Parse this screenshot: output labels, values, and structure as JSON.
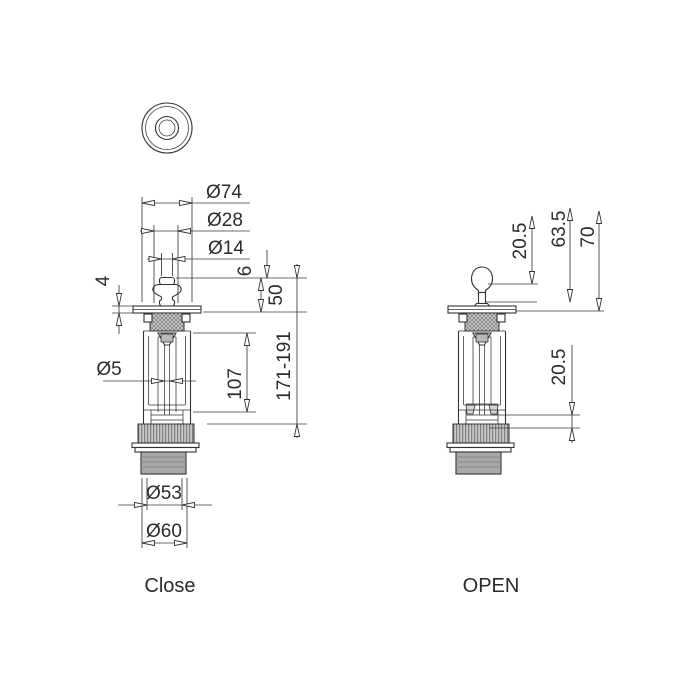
{
  "views": {
    "close": {
      "label": "Close"
    },
    "open": {
      "label": "OPEN"
    }
  },
  "dims": {
    "close": {
      "dia74": "Ø74",
      "dia28": "Ø28",
      "dia14": "Ø14",
      "six": "6",
      "fifty": "50",
      "range": "171-191",
      "one07": "107",
      "four": "4",
      "dia5": "Ø5",
      "dia53": "Ø53",
      "dia60": "Ø60"
    },
    "open": {
      "top_lift": "20.5",
      "mid": "63.5",
      "total": "70",
      "bottom_lift": "20.5"
    }
  },
  "colors": {
    "line": "#333333",
    "text": "#2b2b2b",
    "thread_fill": "#a9a9a9",
    "hatch_fill": "#c9c9c9",
    "background": "#ffffff"
  }
}
